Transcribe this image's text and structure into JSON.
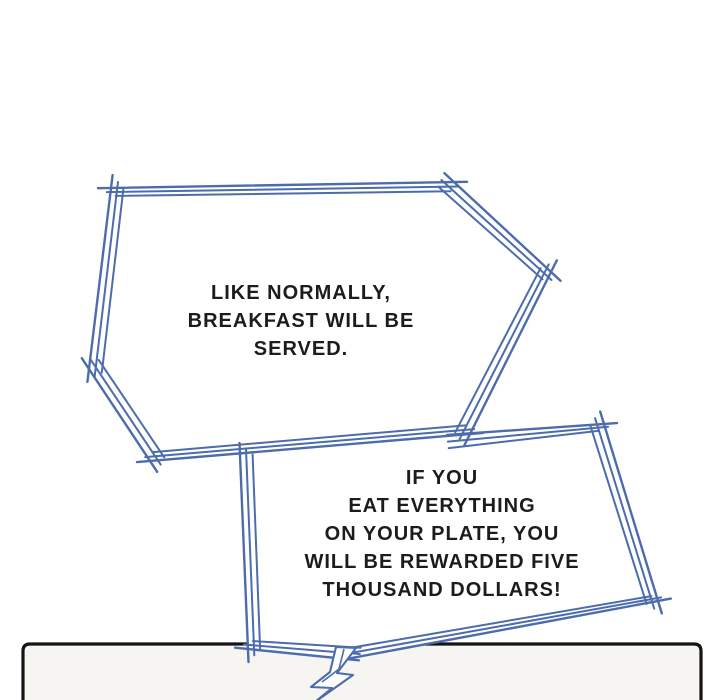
{
  "colors": {
    "background": "#ffffff",
    "bubble_outline": "#4d6cab",
    "bubble_fill": "#ffffff",
    "text": "#1c1c1c",
    "panel_border": "#141414",
    "panel_fill": "#f7f5f1"
  },
  "bubbles": [
    {
      "name": "bubble-1",
      "lines": [
        "LIKE NORMALLY,",
        "BREAKFAST WILL BE",
        "SERVED."
      ]
    },
    {
      "name": "bubble-2",
      "lines": [
        "IF YOU",
        "EAT EVERYTHING",
        "ON YOUR PLATE, YOU",
        "WILL BE REWARDED FIVE",
        "THOUSAND DOLLARS!"
      ]
    }
  ]
}
